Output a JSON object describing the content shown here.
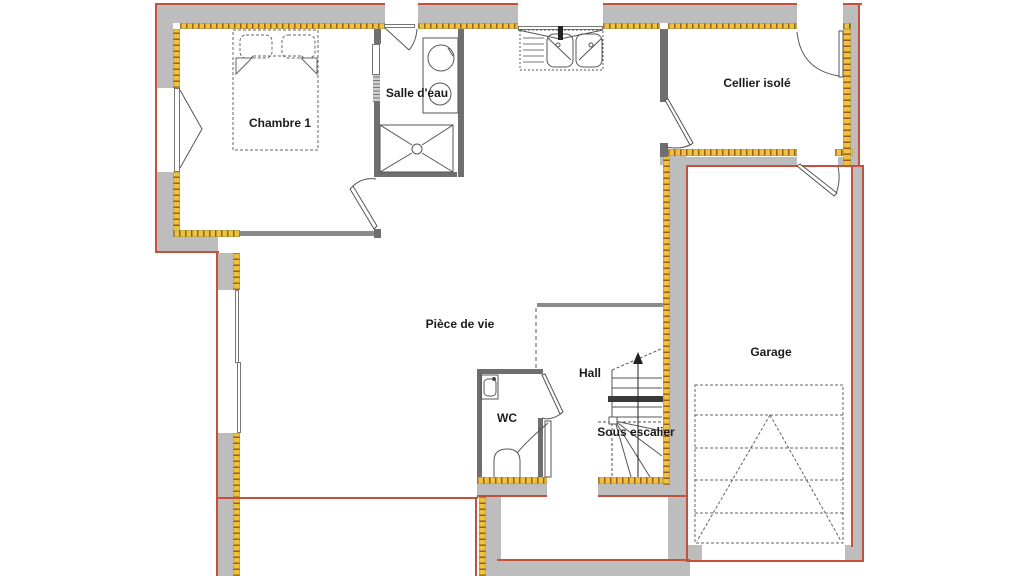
{
  "title": "Plan de rez-de-chaussée",
  "rooms": {
    "chambre1": {
      "label": "Chambre 1"
    },
    "salle_eau": {
      "label": "Salle d'eau"
    },
    "cellier": {
      "label": "Cellier isolé"
    },
    "piece_de_vie": {
      "label": "Pièce de vie"
    },
    "hall": {
      "label": "Hall"
    },
    "wc": {
      "label": "WC"
    },
    "sous_escalier": {
      "label": "Sous escalier"
    },
    "garage": {
      "label": "Garage"
    }
  },
  "colors": {
    "wall-gray": "#bdbdbd",
    "partition-gray": "#8a8a8a",
    "insulation-yellow": "#eac33f",
    "insulation-tick": "#a4571f",
    "outline-red": "#c65040",
    "line-dark": "#555555"
  }
}
